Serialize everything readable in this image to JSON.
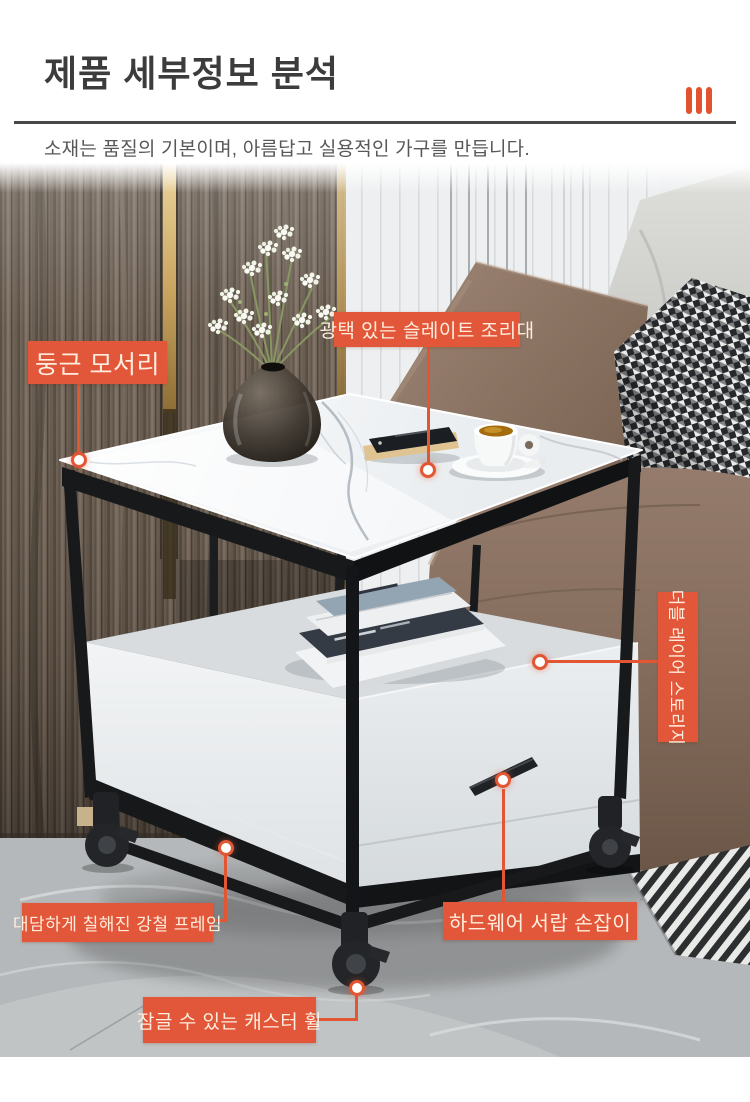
{
  "header": {
    "title": "제품 세부정보 분석",
    "subtitle": "소재는 품질의 기본이며, 아름답고 실용적인 가구를 만듭니다.",
    "accent_color": "#e2573a",
    "accent_icon": "three-bars-icon",
    "divider_color": "#474747"
  },
  "callouts": [
    {
      "id": "rounded-corner",
      "label": "둥근 모서리"
    },
    {
      "id": "glossy-slate-top",
      "label": "광택 있는 슬레이트 조리대"
    },
    {
      "id": "double-layer-storage",
      "label": "더블 레이어 스토리지"
    },
    {
      "id": "painted-steel-frame",
      "label": "대담하게 칠해진 강철 프레임"
    },
    {
      "id": "hardware-drawer-handle",
      "label": "하드웨어 서랍 손잡이"
    },
    {
      "id": "lockable-caster-wheel",
      "label": "잠글 수 있는 캐스터 휠"
    }
  ],
  "scene_objects": [
    "wood-slat-wall",
    "white-slat-wall",
    "gray-cushion",
    "leather-pillow",
    "houndstooth-pillow",
    "sofa-body",
    "striped-throw",
    "marble-floor",
    "side-table",
    "marble-top",
    "steel-frame",
    "storage-shelf",
    "books",
    "drawer",
    "drawer-handle",
    "caster-wheels",
    "vase-with-babys-breath",
    "smartphone",
    "coffee-cup-and-saucer"
  ]
}
